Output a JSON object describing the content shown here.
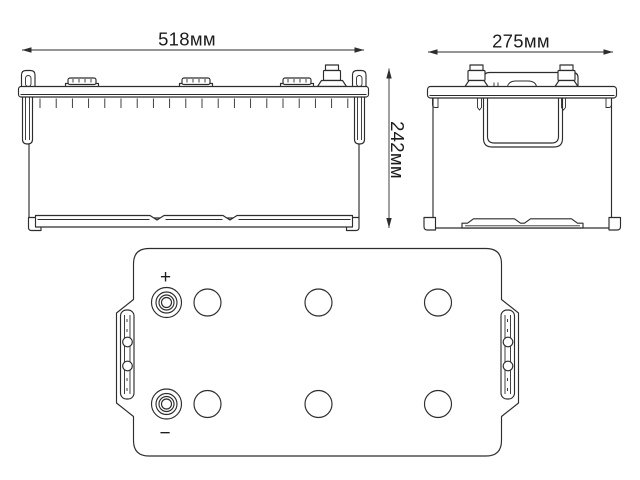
{
  "drawing": {
    "dimension_labels": {
      "width": "518мм",
      "depth": "275мм",
      "height": "242мм"
    },
    "terminal_labels": {
      "positive": "+",
      "negative": "−"
    },
    "colors": {
      "line": "#2d2d2d",
      "text": "#1c1c1c",
      "background": "#ffffff"
    }
  }
}
